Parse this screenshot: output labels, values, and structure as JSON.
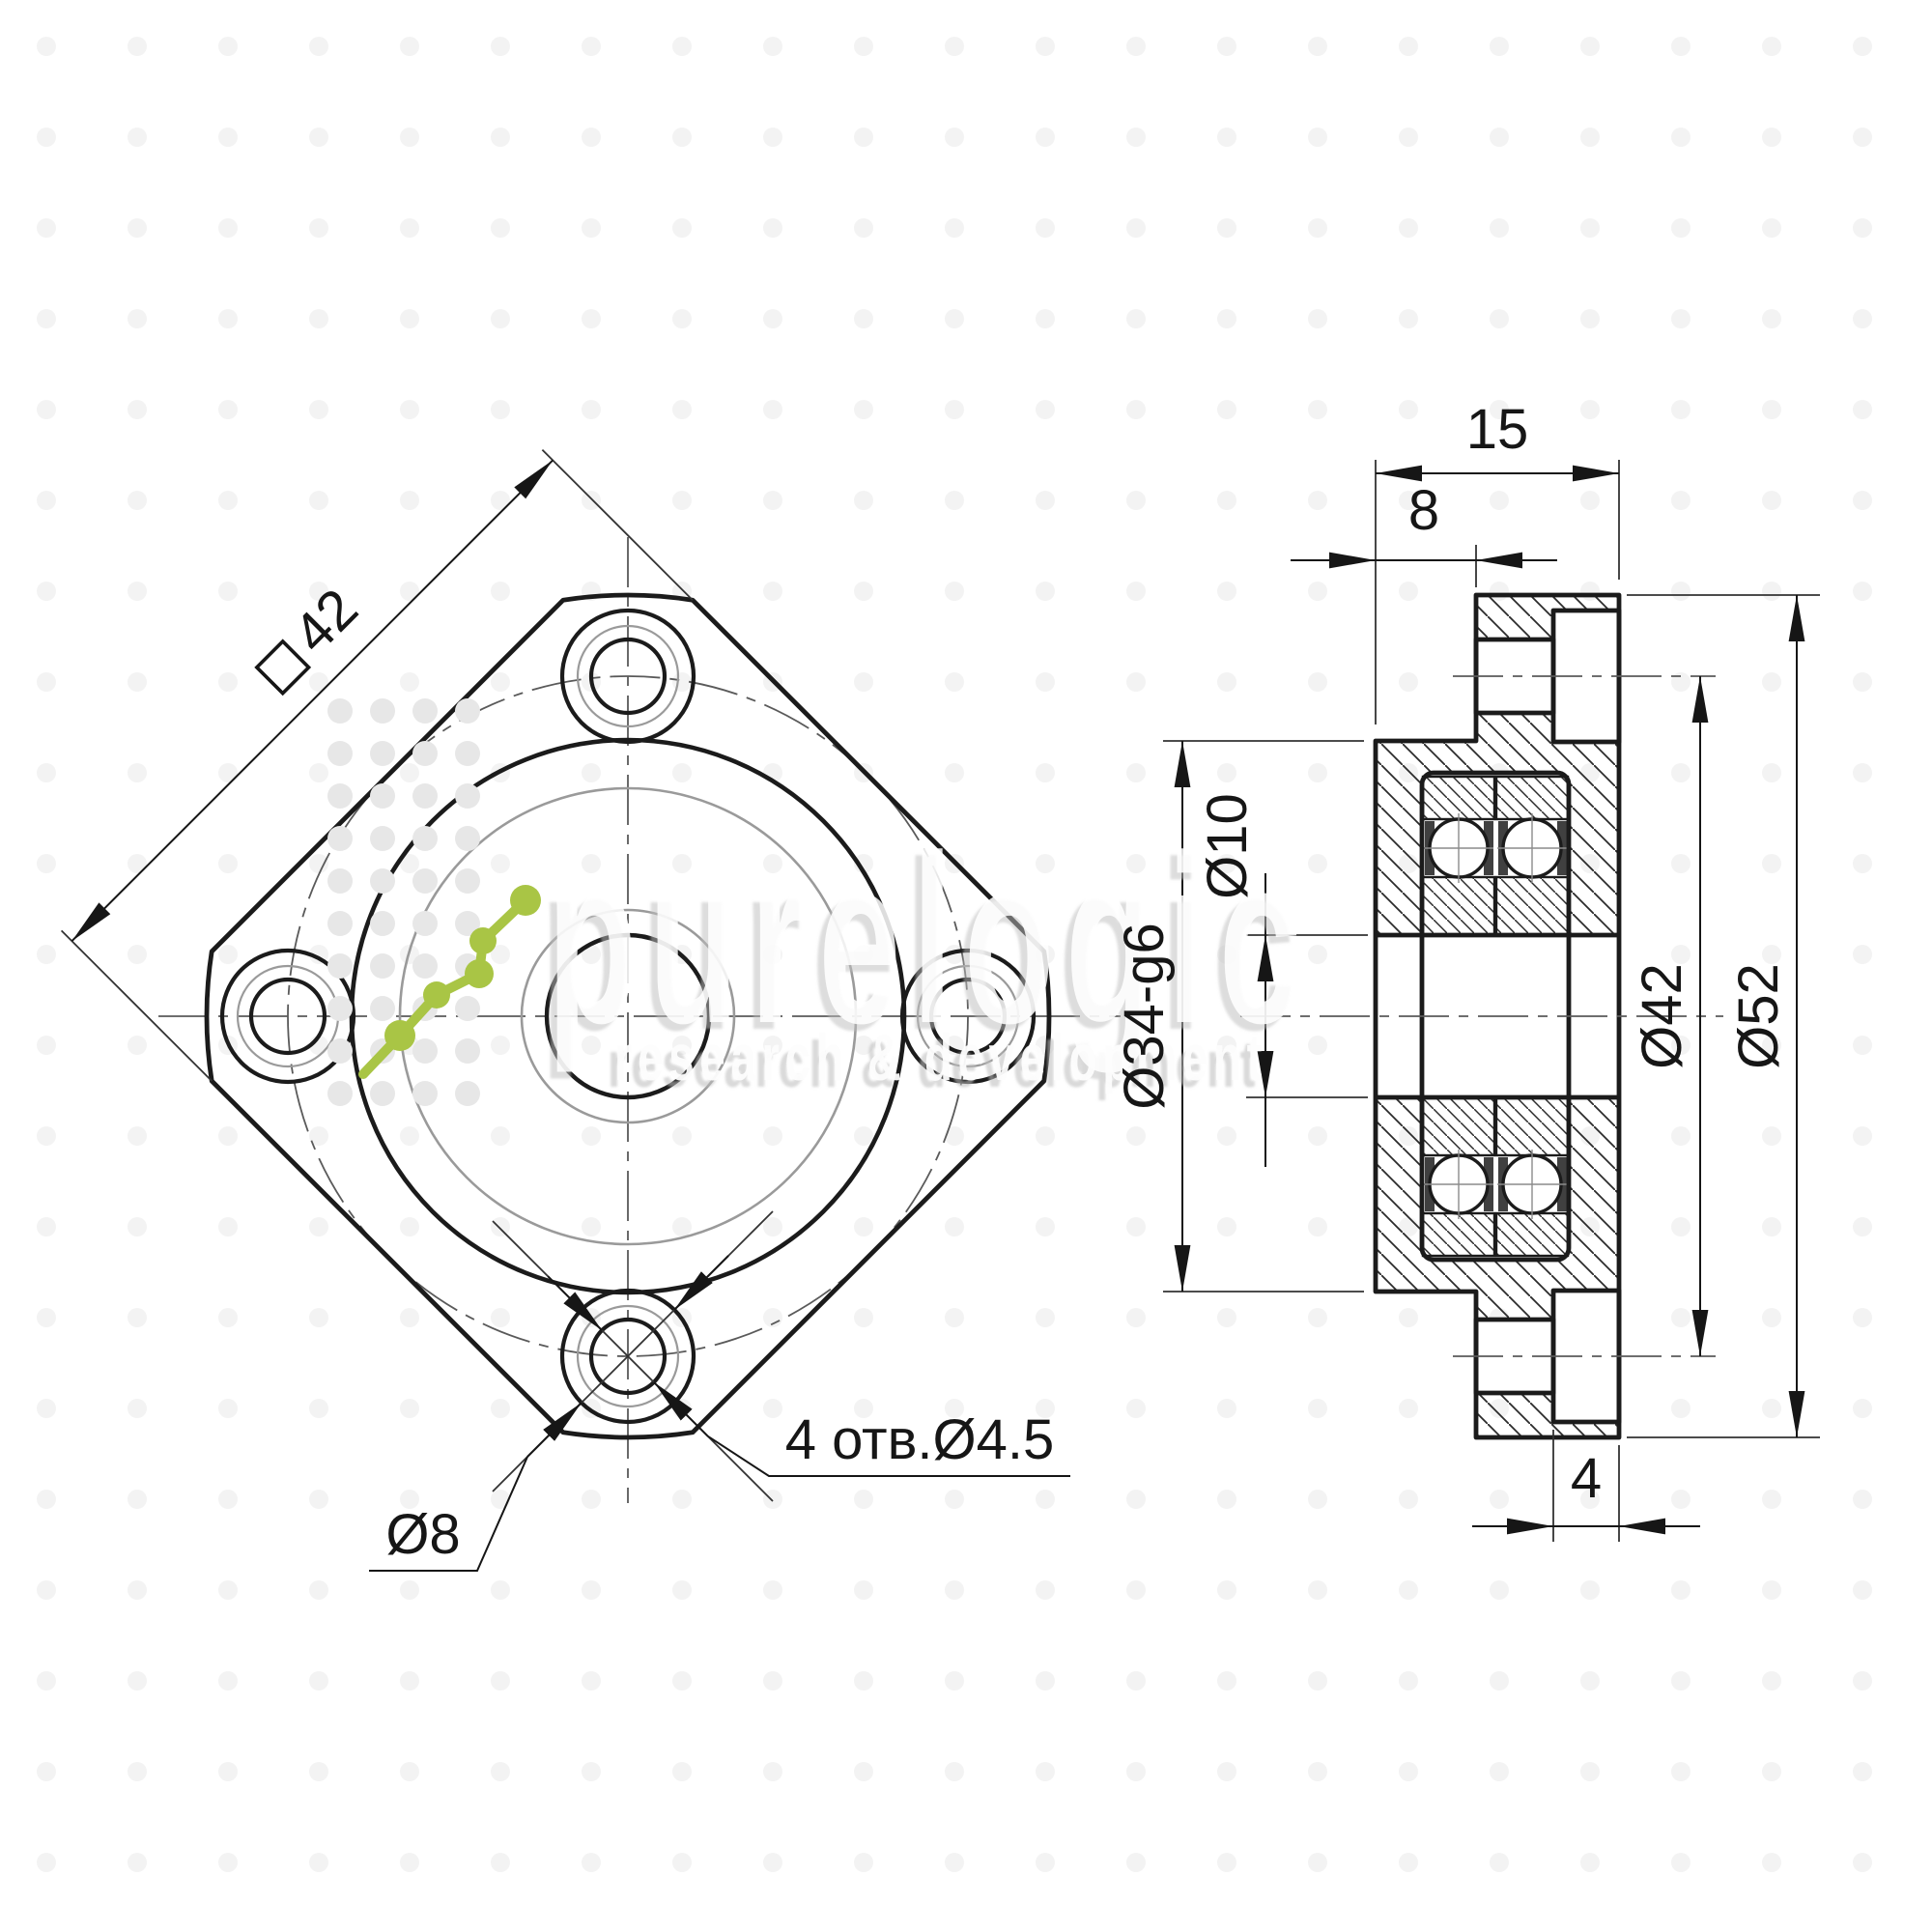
{
  "meta": {
    "type": "engineering-drawing",
    "background_color": "#ffffff",
    "line_color": "#1b1b1b",
    "thin_line_color": "#8f8f8f",
    "centerline_color": "#555555",
    "accent_green": "#a9c545",
    "watermark_gray": "#d9d9d9"
  },
  "watermark": {
    "brand": "purelogic",
    "tagline": "research & development"
  },
  "front_view": {
    "square_symbol": "square-42-flange",
    "square_value": "42",
    "counterbore_dia_label": "Ø8",
    "holes_note": "4 отв.Ø4.5"
  },
  "section_view": {
    "total_width": "15",
    "flange_offset": "8",
    "cbore_depth": "4",
    "outer_dia": "Ø52",
    "bolt_circle_dia": "Ø42",
    "pilot_dia": "Ø34-g6",
    "bore_dia": "Ø10"
  }
}
